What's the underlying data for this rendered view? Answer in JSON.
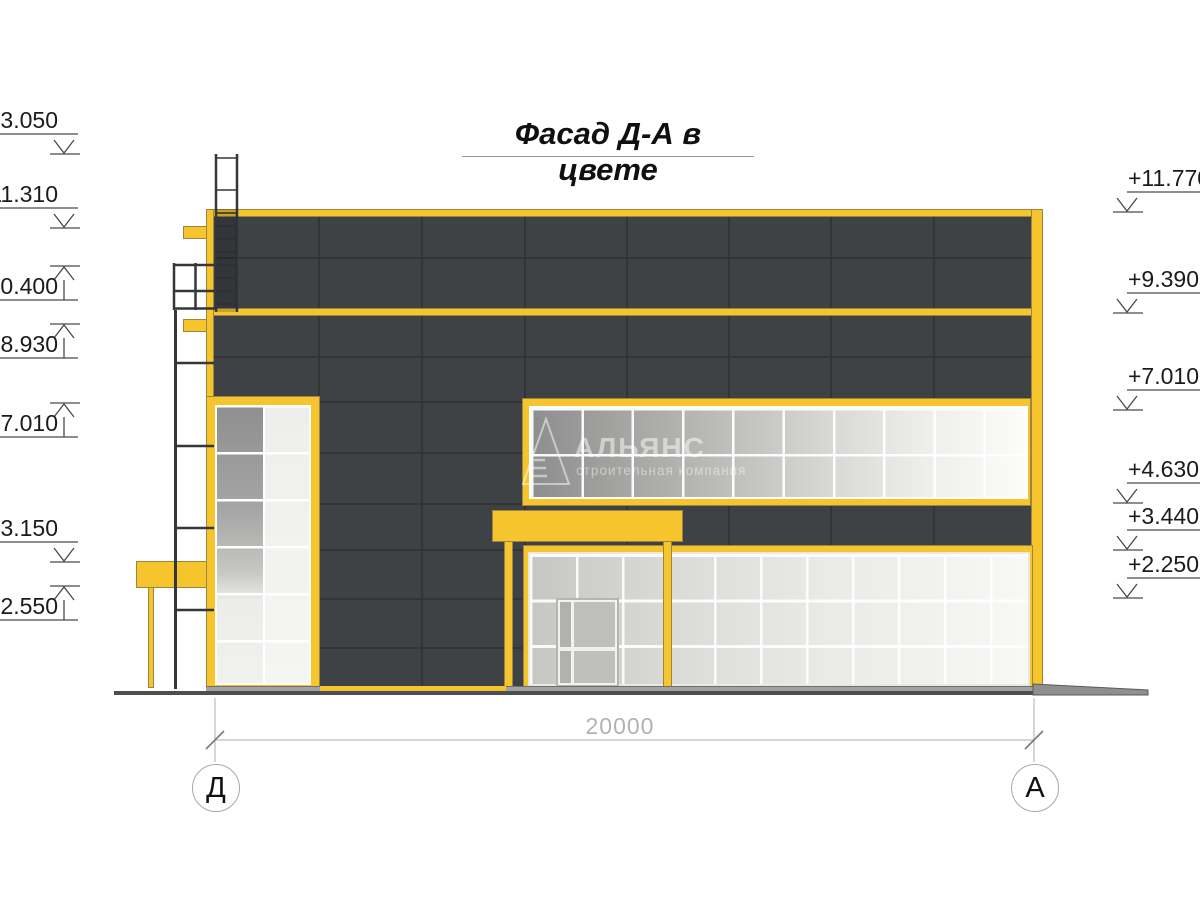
{
  "title": "Фасад Д-А в цвете",
  "watermark": {
    "name": "АЛЬЯНС",
    "subtitle": "строительная компания"
  },
  "dimension": {
    "total": "20000"
  },
  "axes": [
    {
      "label": "Д"
    },
    {
      "label": "А"
    }
  ],
  "elevations": {
    "left": [
      {
        "value": "13.050",
        "direction": "down"
      },
      {
        "value": "11.310",
        "direction": "down"
      },
      {
        "value": "10.400",
        "direction": "up"
      },
      {
        "value": "8.930",
        "direction": "up"
      },
      {
        "value": "7.010",
        "direction": "up"
      },
      {
        "value": "3.150",
        "direction": "down"
      },
      {
        "value": "2.550",
        "direction": "up"
      }
    ],
    "right": [
      {
        "value": "+11.770",
        "direction": "down"
      },
      {
        "value": "+9.390",
        "direction": "down"
      },
      {
        "value": "+7.010",
        "direction": "down"
      },
      {
        "value": "+4.630",
        "direction": "down"
      },
      {
        "value": "+3.440",
        "direction": "down"
      },
      {
        "value": "+2.250",
        "direction": "down"
      }
    ]
  },
  "colors": {
    "accent_yellow": "#F6C52E",
    "panel_dark": "#3E4245",
    "panel_joint": "#2F3336",
    "annotation_line": "#4A4A4A"
  }
}
